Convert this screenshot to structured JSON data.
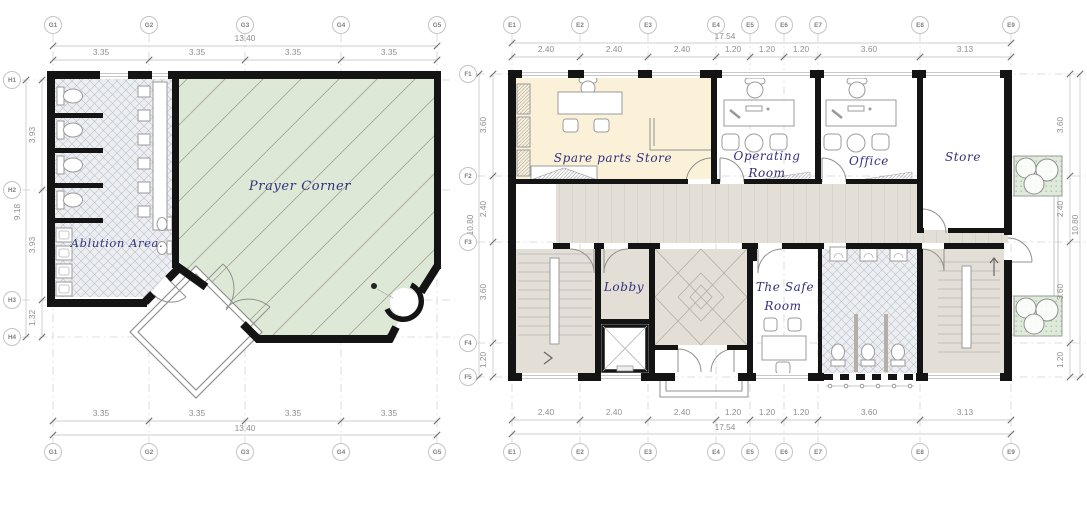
{
  "left_plan": {
    "rooms": {
      "prayer": "Prayer Corner",
      "ablution": "Ablution Area."
    },
    "grid_x": [
      "G1",
      "G2",
      "G3",
      "G4",
      "G5"
    ],
    "grid_y": [
      "H1",
      "H2",
      "H3",
      "H4"
    ],
    "dims_x": [
      "3.35",
      "3.35",
      "3.35",
      "3.35"
    ],
    "total_x": "13.40",
    "dims_y": [
      "3.93",
      "3.93",
      "1.32"
    ],
    "total_y": "9.18"
  },
  "right_plan": {
    "rooms": {
      "spare_parts_store": "Spare parts Store",
      "operating_room_line1": "Operating",
      "operating_room_line2": "Room",
      "office": "Office",
      "store": "Store",
      "lobby": "Lobby",
      "safe_room_line1": "The Safe",
      "safe_room_line2": "Room"
    },
    "grid_x": [
      "E1",
      "E2",
      "E3",
      "E4",
      "E5",
      "E6",
      "E7",
      "E8",
      "E9"
    ],
    "grid_y": [
      "F1",
      "F2",
      "F3",
      "F4",
      "F5"
    ],
    "dims_x": [
      "2.40",
      "2.40",
      "2.40",
      "1.20",
      "1.20",
      "1.20",
      "3.60",
      "3.13"
    ],
    "total_x": "17.54",
    "dims_y": [
      "3.60",
      "2.40",
      "3.60",
      "1.20"
    ],
    "total_y": "10.80"
  },
  "colors": {
    "wall": "#141414",
    "prayer_floor": "#dde9d6",
    "tile_floor": "#eaeef5",
    "spare_floor": "#faf1d8",
    "circulation_floor": "#e3dfd7",
    "planter": "#dfeadb",
    "label_ink": "#31317c",
    "dimension_ink": "#8f8f8f"
  }
}
